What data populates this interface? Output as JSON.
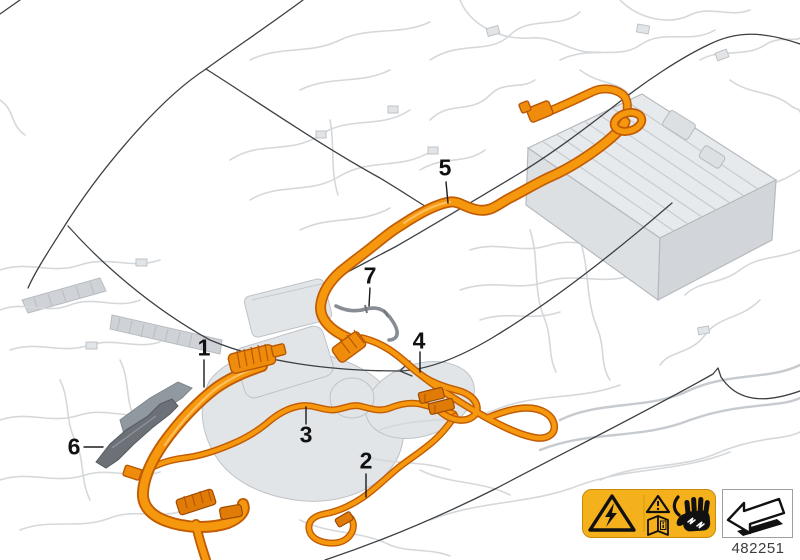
{
  "diagram": {
    "description": "High-voltage wiring harness parts diagram",
    "callouts": [
      {
        "label": "1"
      },
      {
        "label": "2"
      },
      {
        "label": "3"
      },
      {
        "label": "4"
      },
      {
        "label": "5"
      },
      {
        "label": "6"
      },
      {
        "label": "7"
      }
    ],
    "colors": {
      "cable_orange": "#F6980E",
      "cable_orange_dark": "#C25C04",
      "harness_gray": "#D5D8DB",
      "body_outline": "#3C4043",
      "heat_shield_dark": "#6C7177",
      "cable7_gray": "#878D93"
    }
  },
  "warning_label": {
    "background": "#F5B11B",
    "icons": [
      {
        "name": "high-voltage-triangle-icon"
      },
      {
        "name": "warning-triangle-icon"
      },
      {
        "name": "consult-manual-icon"
      },
      {
        "name": "insulated-gloves-icon"
      }
    ]
  },
  "footer": {
    "part_number": "482251",
    "arrow_icon": "direction-of-travel-arrow-icon"
  }
}
